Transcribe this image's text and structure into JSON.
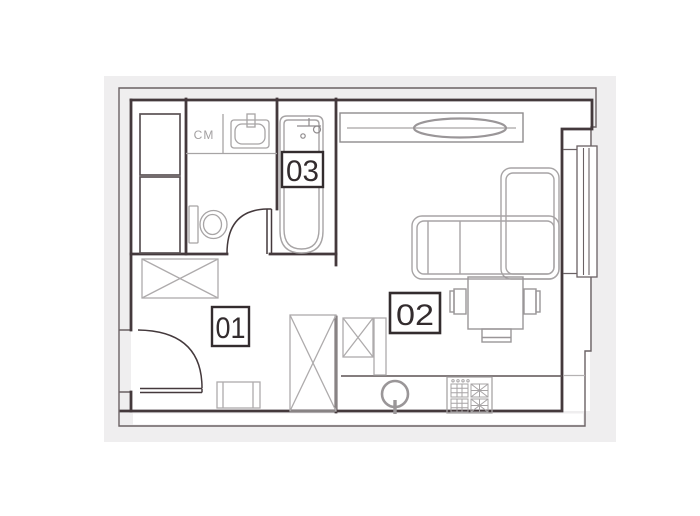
{
  "floor_plan": {
    "title": "studio-apartment-floor-plan",
    "rooms": [
      {
        "number": "01"
      },
      {
        "number": "02"
      },
      {
        "number": "03"
      }
    ],
    "labels": {
      "washing_machine": "CM"
    },
    "fixtures": [
      "washing-machine",
      "washbasin",
      "bathtub",
      "toilet",
      "bathroom-door",
      "entry-door",
      "wardrobe",
      "tall-wardrobe",
      "bench",
      "closet-with-rod",
      "sofa",
      "dining-table",
      "chair",
      "stool",
      "kitchen-counter",
      "kitchen-cabinet",
      "round-sink",
      "stove",
      "window"
    ],
    "colors": {
      "wall": "#44393c",
      "boundary": "#6a6164",
      "furniture_light": "#a7a4a5",
      "furniture_dark": "#5b5254",
      "halo": "#efeeef",
      "floor": "#ffffff",
      "label_border": "#332c2e",
      "label_text": "#332c2e"
    }
  }
}
